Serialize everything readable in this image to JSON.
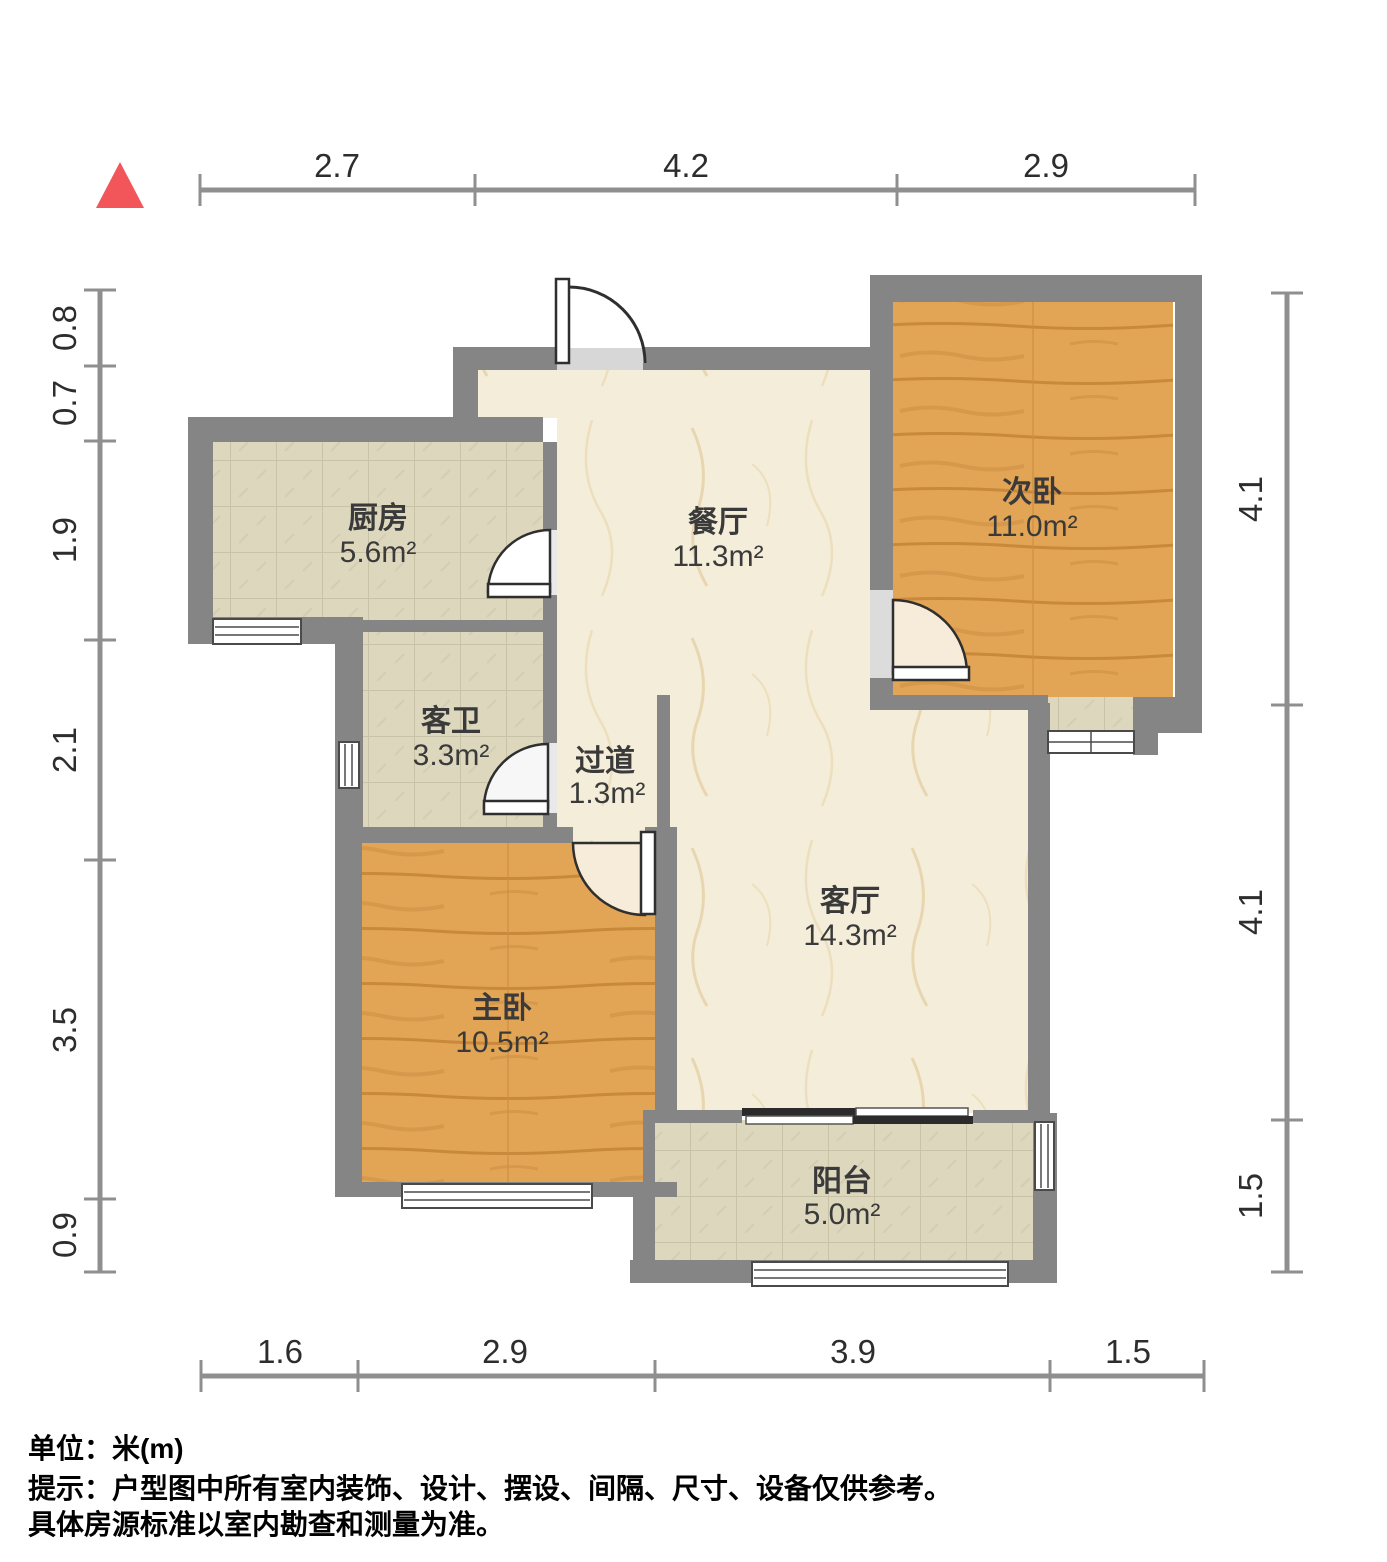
{
  "rooms": {
    "kitchen": {
      "name": "厨房",
      "area": "5.6m²"
    },
    "dining": {
      "name": "餐厅",
      "area": "11.3m²"
    },
    "bedroom2": {
      "name": "次卧",
      "area": "11.0m²"
    },
    "bath": {
      "name": "客卫",
      "area": "3.3m²"
    },
    "hallway": {
      "name": "过道",
      "area": "1.3m²"
    },
    "living": {
      "name": "客厅",
      "area": "14.3m²"
    },
    "master": {
      "name": "主卧",
      "area": "10.5m²"
    },
    "balcony": {
      "name": "阳台",
      "area": "5.0m²"
    }
  },
  "dimensions": {
    "top": [
      "2.7",
      "4.2",
      "2.9"
    ],
    "bottom": [
      "1.6",
      "2.9",
      "3.9",
      "1.5"
    ],
    "left": [
      "0.8",
      "0.7",
      "1.9",
      "2.1",
      "3.5",
      "0.9"
    ],
    "right": [
      "4.1",
      "4.1",
      "1.5"
    ]
  },
  "footer": {
    "unit": "单位：米(m)",
    "tip": "提示：户型图中所有室内装饰、设计、摆设、间隔、尺寸、设备仅供参考。",
    "tip2": "具体房源标准以室内勘查和测量为准。"
  },
  "colors": {
    "wall": "#858585",
    "threshold": "#d7d7d7",
    "tile": "#dcd7bd",
    "marble": "#f4edda",
    "wood": "#e2a455",
    "north_marker": "#f2555a",
    "dim_line": "#8f8f8f"
  }
}
